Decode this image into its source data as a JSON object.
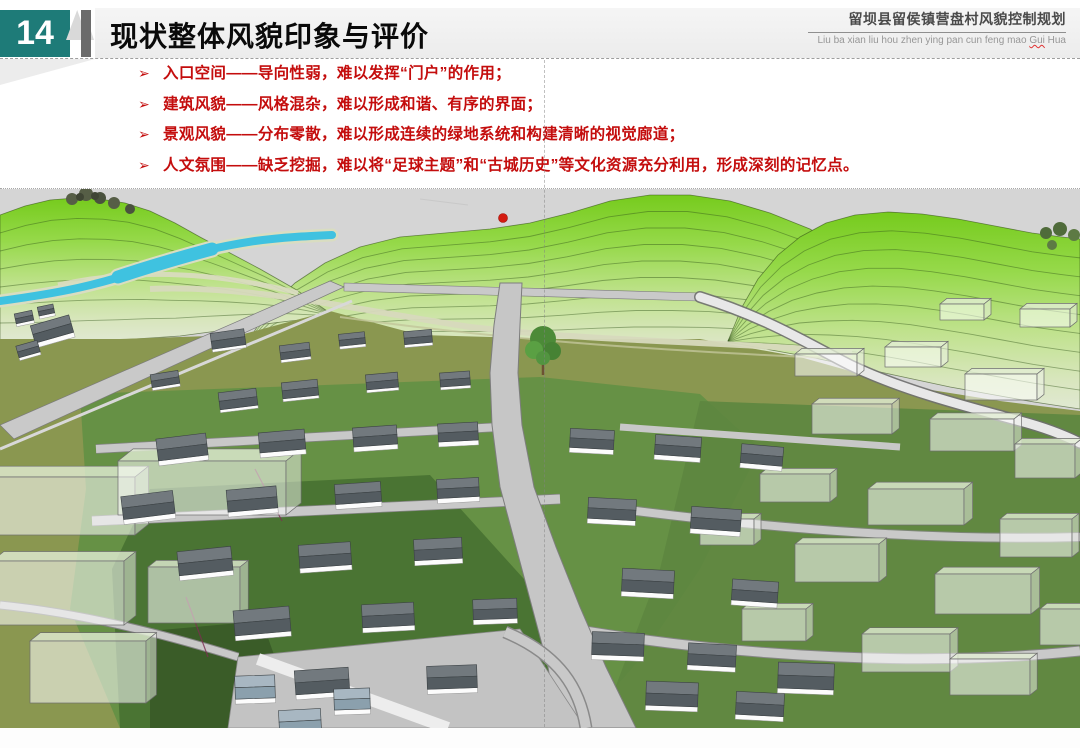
{
  "header": {
    "page_number": "14",
    "title": "现状整体风貌印象与评价",
    "project_title": "留坝县留侯镇营盘村风貌控制规划",
    "project_pinyin_prefix": "Liu ba xian liu hou zhen ying pan cun feng mao ",
    "project_pinyin_marked": "Gui",
    "project_pinyin_suffix": " Hua"
  },
  "bullets": {
    "marker": "➢",
    "items": [
      {
        "text": "入口空间——导向性弱，难以发挥“门户”的作用；"
      },
      {
        "text": "建筑风貌——风格混杂，难以形成和谐、有序的界面；"
      },
      {
        "text": "景观风貌——分布零散，难以形成连续的绿地系统和构建清晰的视觉廊道；"
      },
      {
        "text": "人文氛围——缺乏挖掘，难以将“足球主题”和“古城历史”等文化资源充分利用，形成深刻的记忆点。"
      }
    ]
  },
  "colors": {
    "accent_teal": "#1e7b78",
    "bullet_red": "#c40d0d",
    "sky_gray": "#d5d5d5",
    "hill_green_top": "#76cb1d",
    "hill_green_base": "#e0e8d2",
    "field_olive": "#8a9750",
    "river_blue": "#3fc2e0",
    "roof_slate": "#545c61",
    "road_gray": "#c6c6c6",
    "red_marker": "#d41b10"
  }
}
